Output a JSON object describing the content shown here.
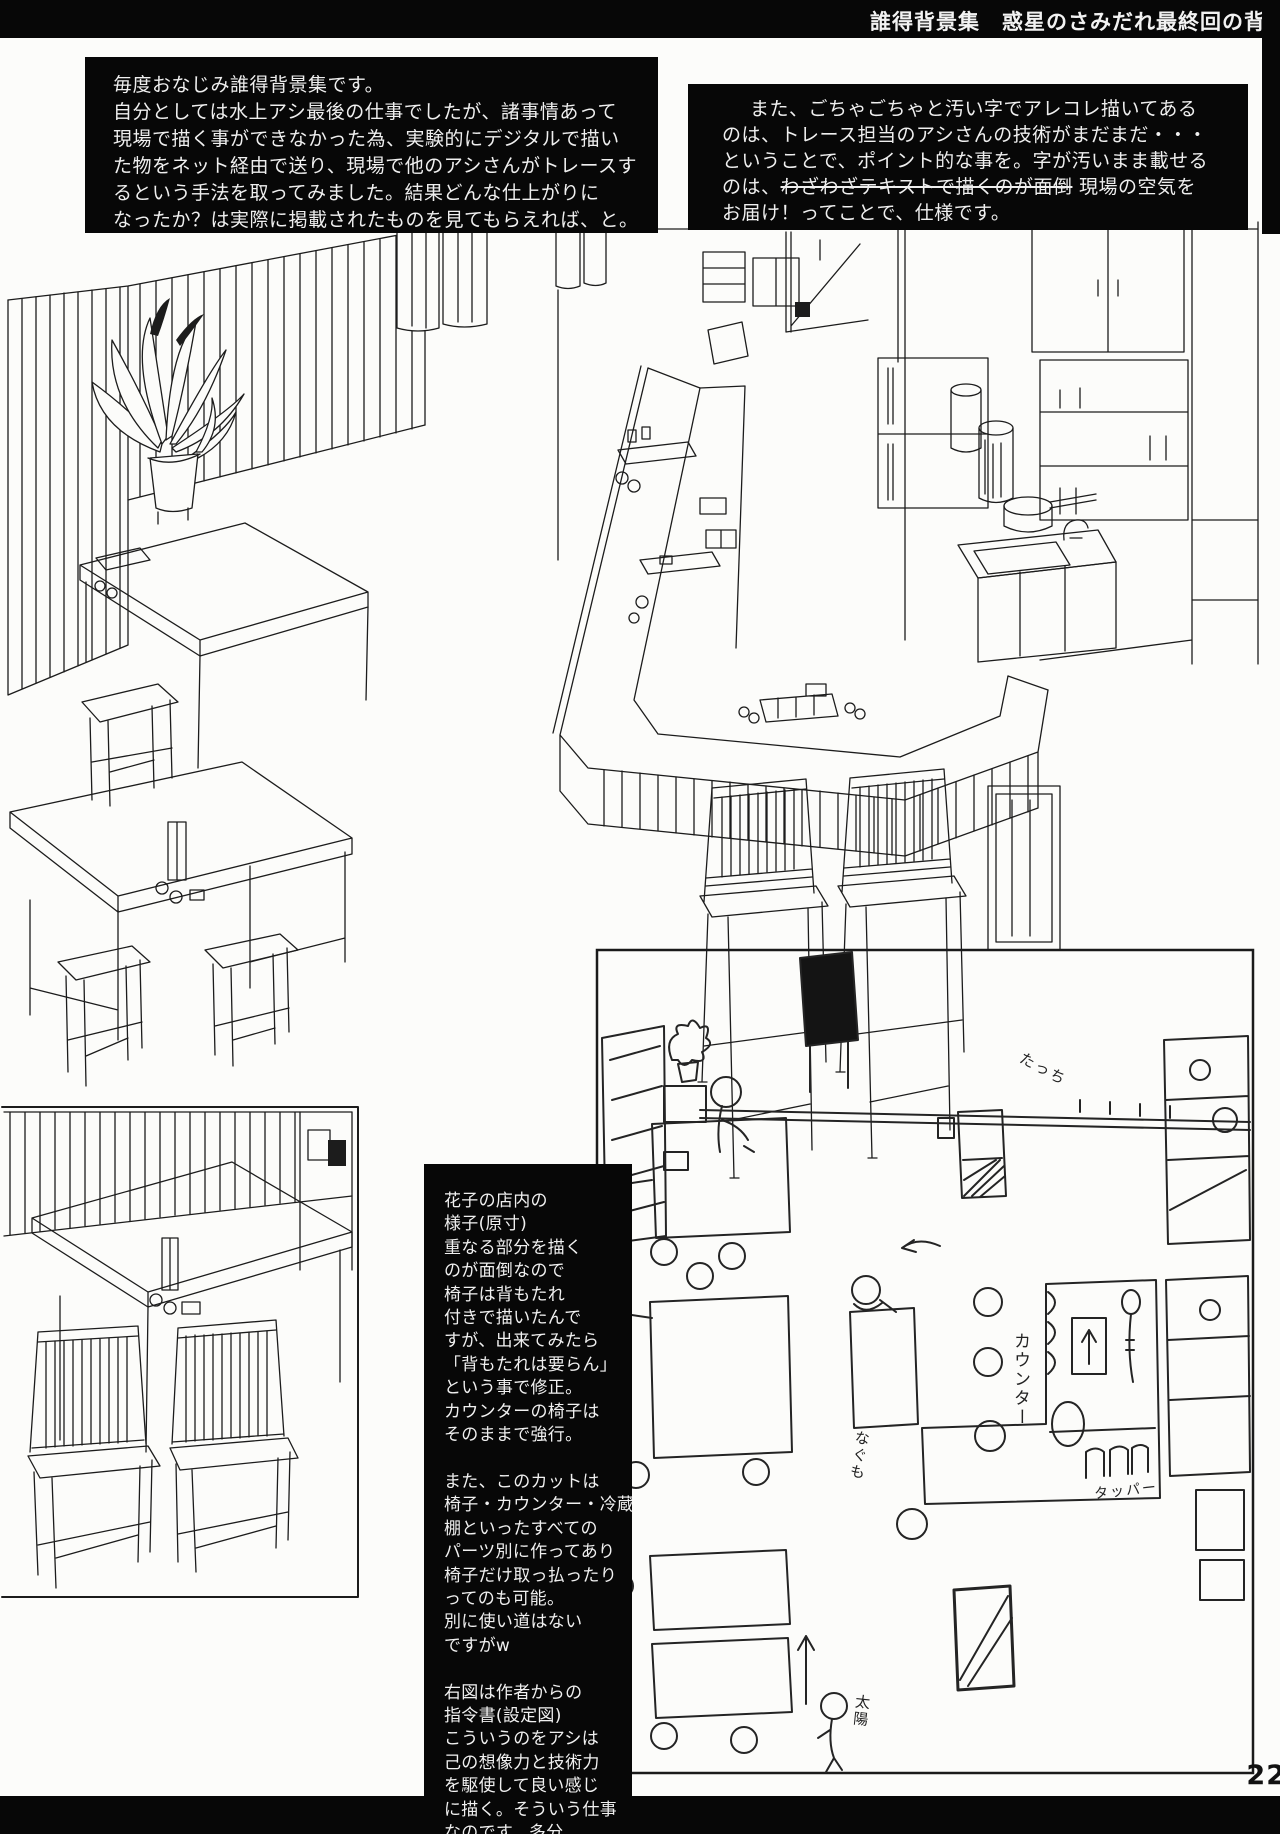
{
  "header": {
    "title": "誰得背景集　惑星のさみだれ最終回の背景"
  },
  "note_left": {
    "lines": [
      "毎度おなじみ誰得背景集です。",
      "自分としては水上アシ最後の仕事でしたが、諸事情あって",
      "現場で描く事ができなかった為、実験的にデジタルで描い",
      "た物をネット経由で送り、現場で他のアシさんがトレースす",
      "るという手法を取ってみました。結果どんな仕上がりに",
      "なったか？は実際に掲載されたものを見てもらえれば、と。"
    ]
  },
  "note_right": {
    "line1": "また、ごちゃごちゃと汚い字でアレコレ描いてある",
    "line2": "のは、トレース担当のアシさんの技術がまだまだ・・・",
    "line3": "ということで、ポイント的な事を。字が汚いまま載せる",
    "line4_pre": "のは、",
    "line4_strike": "わざわざテキストで描くのが面倒",
    "line4_post": " 現場の空気を",
    "line5": "お届け！ってことで、仕様です。"
  },
  "caption": {
    "lines": [
      "花子の店内の",
      "様子(原寸)",
      "重なる部分を描く",
      "のが面倒なので",
      "椅子は背もたれ",
      "付きで描いたんで",
      "すが、出来てみたら",
      "「背もたれは要らん」",
      "という事で修正。",
      "カウンターの椅子は",
      "そのままで強行。",
      "",
      "また、このカットは",
      "椅子・カウンター・冷蔵庫",
      "棚といったすべての",
      "パーツ別に作ってあり",
      "椅子だけ取っ払ったり",
      "ってのも可能。",
      "別に使い道はない",
      "ですがw",
      "",
      "右図は作者からの",
      "指令書(設定図)",
      "こういうのをアシは",
      "己の想像力と技術力",
      "を駆使して良い感じ",
      "に描く。そういう仕事",
      "なのです。多分。"
    ]
  },
  "sketch": {
    "labels": {
      "counter": "カウンター",
      "tupper": "タッパー",
      "nagumo": "なぐも",
      "taiyou": "太陽",
      "tacchi": "たっち"
    }
  },
  "page": {
    "number": "22"
  }
}
